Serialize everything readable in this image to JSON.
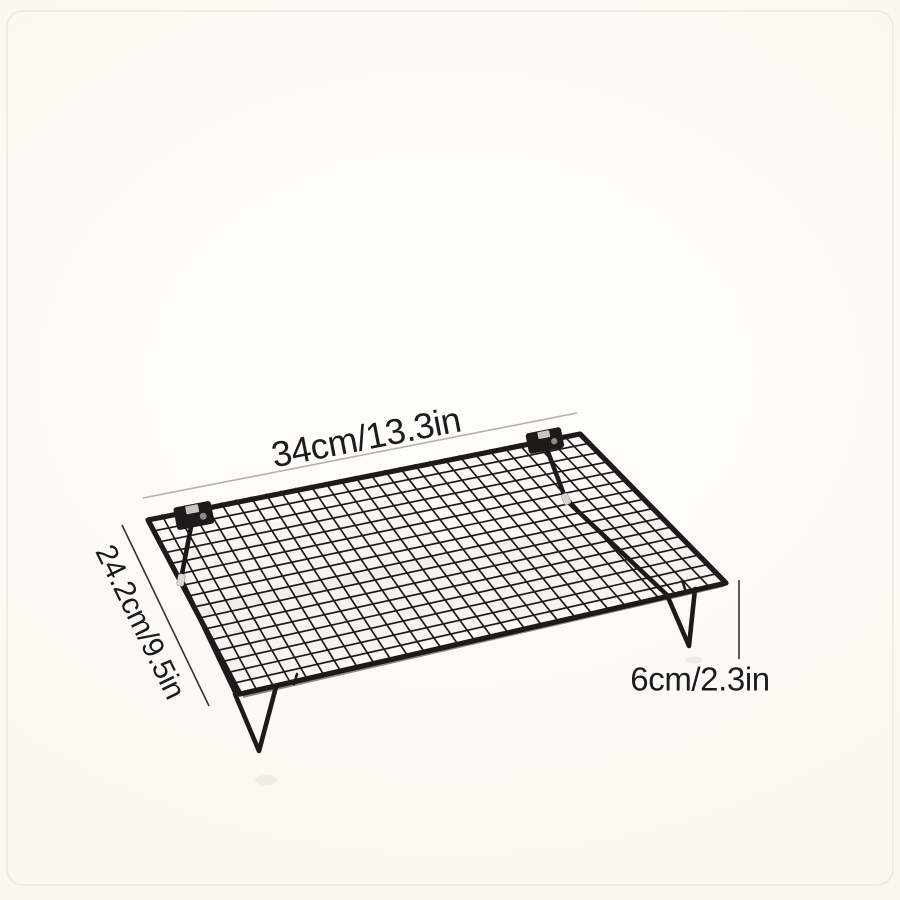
{
  "subject": "black-wire-cooling-rack-product-photo",
  "annotations": {
    "width_label": "34cm/13.3in",
    "depth_label": "24.2cm/9.5in",
    "height_label": "6cm/2.3in"
  },
  "colors": {
    "rack_wire": "#1c1b19",
    "background_center": "#fffef9",
    "background_edge": "#faf7f0",
    "dimension_line_light": "#b5b1a8",
    "dimension_line_dark": "#33332f",
    "label_text": "#1c1c1c"
  }
}
